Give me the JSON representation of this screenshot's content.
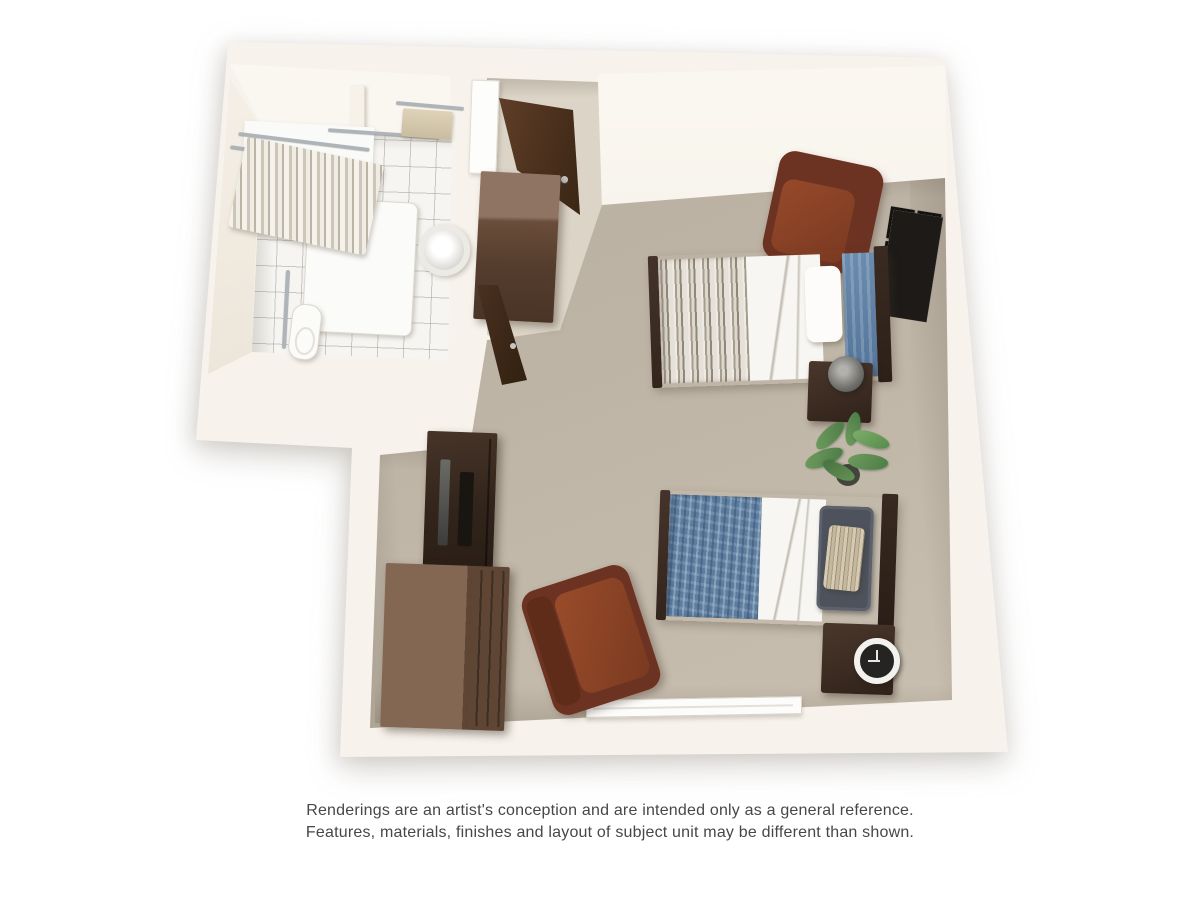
{
  "disclaimer": {
    "line1": "Renderings are an artist's conception and are intended only as a general reference.",
    "line2": "Features, materials, finishes and layout of subject unit may be different than shown."
  },
  "scene": {
    "type": "3d-floor-plan-rendering",
    "rooms": [
      "bathroom",
      "entry-hall",
      "studio-bedroom-living-area"
    ],
    "furniture": [
      "shower-with-striped-curtain",
      "towel-bar-with-towel",
      "pedestal-sink",
      "toilet",
      "grab-bars",
      "entry-door",
      "bathroom-door",
      "entry-wardrobe-cabinet",
      "leather-armchair-upper",
      "leather-armchair-lower",
      "twin-bed-upper",
      "twin-bed-lower",
      "nightstand-with-lamp",
      "nightstand-with-clock",
      "picture-frame-gallery-6",
      "potted-plant",
      "tv-cabinet",
      "dresser",
      "window-sill"
    ],
    "palette": {
      "background": "#ffffff",
      "wall": "#f7f3ec",
      "carpet": "#beb4a6",
      "hall_floor": "#dbd4c7",
      "tile_floor": "#f6f5f2",
      "dark_wood": "#33251d",
      "medium_wood": "#6a4d3a",
      "leather": "#7a3a21",
      "bedding_blue": "#5c7da0",
      "bedding_white": "#f8f6f2",
      "text": "#474747"
    }
  }
}
